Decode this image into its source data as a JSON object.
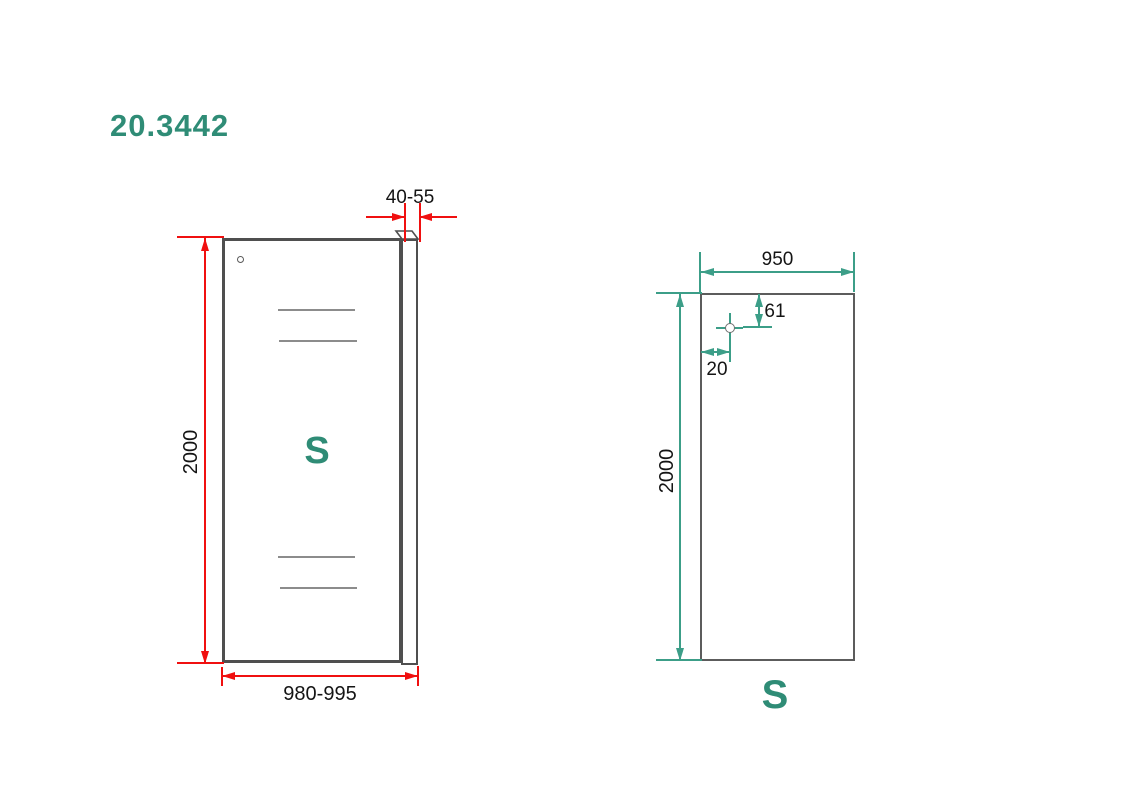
{
  "title": "20.3442",
  "colors": {
    "teal_text": "#2F8C76",
    "teal_dim": "#3C9E88",
    "red_dim": "#F01010",
    "outline_dark": "#4F4F4F",
    "outline_light": "#5C5C5C",
    "glass_line": "#8C8C8C"
  },
  "front_view": {
    "label": "S",
    "dims": {
      "profile_width": "40-55",
      "height": "2000",
      "width": "980-995"
    }
  },
  "side_view": {
    "label": "S",
    "dims": {
      "width": "950",
      "height": "2000",
      "hole_from_top": "61",
      "hole_from_edge": "20"
    }
  }
}
